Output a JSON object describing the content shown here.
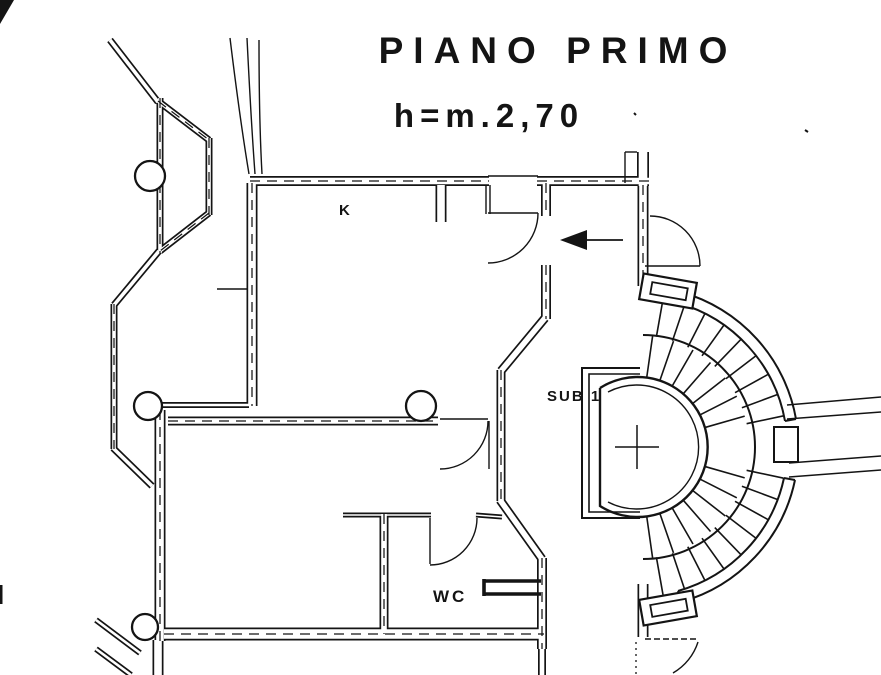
{
  "document": {
    "kind": "floor-plan-drawing",
    "title": "PIANO PRIMO",
    "height_note": "h=m.2,70",
    "room_labels": {
      "kitchen": "K",
      "subunit": "SUB 1",
      "wc": "WC"
    },
    "colors": {
      "ink": "#141414",
      "paper": "#ffffff"
    }
  }
}
